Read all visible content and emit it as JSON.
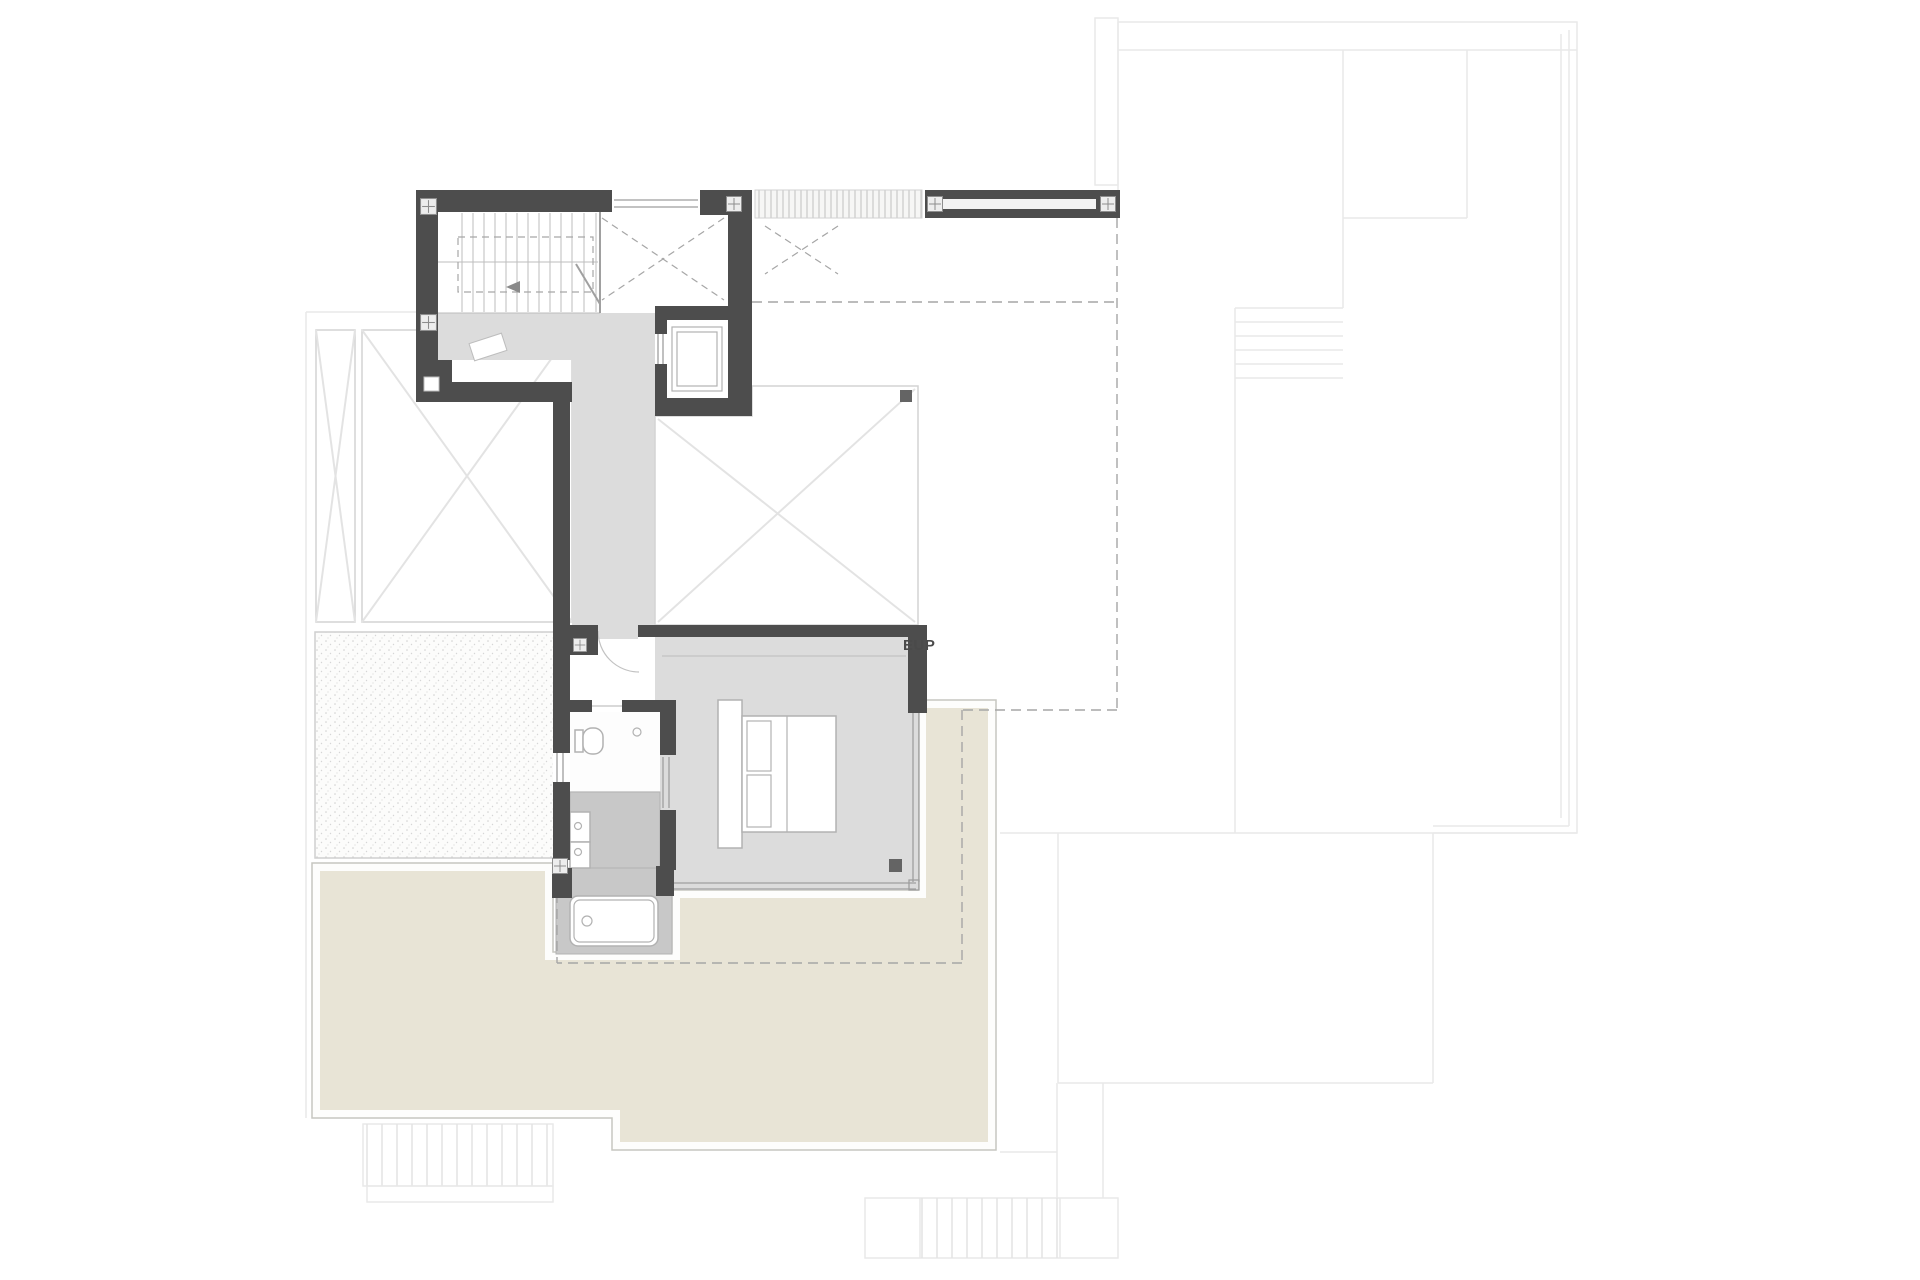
{
  "watermark": {
    "text": "EUP"
  },
  "colors": {
    "paper": "#ffffff",
    "wall": "#4d4d4d",
    "floor": "#dcdcdc",
    "tile": "#c8c8c8",
    "terrace": "#e8e4d6",
    "terrace_edge": "#c6c6c0",
    "room_line": "#d3d3d3",
    "x_line": "#e3e3e3",
    "faint": "#e9e9e9",
    "dash": "#a6a6a6",
    "fixture": "#b2b2b2",
    "glazing": "#9e9e9e",
    "stair_line": "#bdbdbd",
    "column_fill": "#ededed",
    "column_stroke": "#8d8d8d",
    "drain": "#646464",
    "text": "#4a4a4a"
  },
  "symbols": {
    "staircase": "staircase-symbol",
    "elevator": "elevator-symbol",
    "bed": "bed-symbol",
    "bathtub": "bathtub-symbol",
    "toilet": "toilet-symbol",
    "washbasin": "double-washbasin-symbol",
    "column": "structural-column-symbol",
    "void": "double-height-void-cross",
    "gravel": "gravel-roof-stipple",
    "pergola": "pergola-slats"
  }
}
